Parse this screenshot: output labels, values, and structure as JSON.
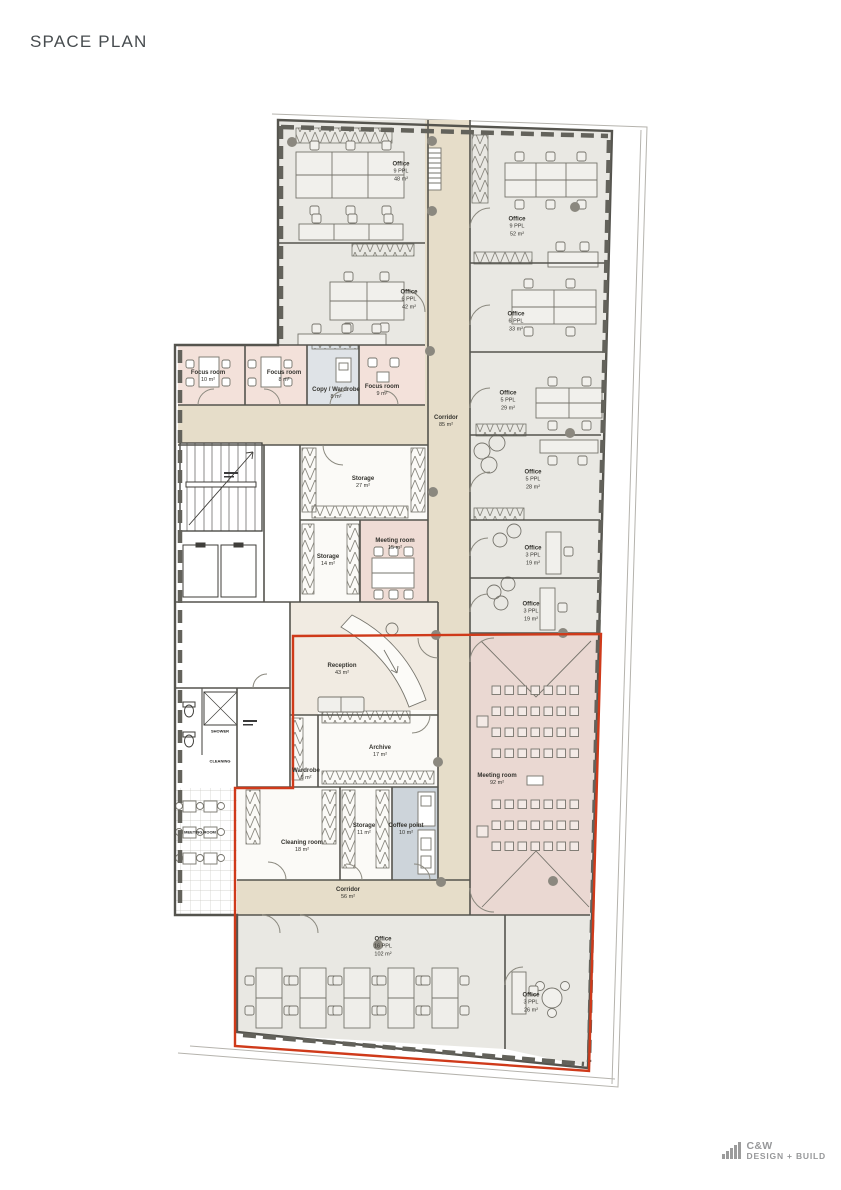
{
  "title": "SPACE PLAN",
  "logo": {
    "name": "C&W",
    "tagline": "DESIGN + BUILD"
  },
  "colors": {
    "corridor": "#e6ddc9",
    "office": "#e9e8e3",
    "focus_room": "#f3e1da",
    "meeting_room": "#ead8d2",
    "coffee_point": "#cdd4da",
    "reception": "#f1ebe2",
    "storage": "#fbfaf7",
    "wall": "#55544e",
    "highlight_outline": "#cf3a1a"
  },
  "rooms": [
    {
      "name": "Office",
      "ppl": "9 PPL",
      "area": "48 m²"
    },
    {
      "name": "Office",
      "ppl": "6 PPL",
      "area": "42 m²"
    },
    {
      "name": "Office",
      "ppl": "9 PPL",
      "area": "52 m²"
    },
    {
      "name": "Office",
      "ppl": "6 PPL",
      "area": "33 m²"
    },
    {
      "name": "Office",
      "ppl": "5 PPL",
      "area": "29 m²"
    },
    {
      "name": "Office",
      "ppl": "5 PPL",
      "area": "28 m²"
    },
    {
      "name": "Office",
      "ppl": "3 PPL",
      "area": "19 m²"
    },
    {
      "name": "Office",
      "ppl": "3 PPL",
      "area": "19 m²"
    },
    {
      "name": "Focus room",
      "ppl": "",
      "area": "10 m²"
    },
    {
      "name": "Focus room",
      "ppl": "",
      "area": "8 m²"
    },
    {
      "name": "Copy / Wardrobe",
      "ppl": "",
      "area": "8 m²"
    },
    {
      "name": "Focus room",
      "ppl": "",
      "area": "9 m²"
    },
    {
      "name": "Corridor",
      "ppl": "",
      "area": "85 m²"
    },
    {
      "name": "Storage",
      "ppl": "",
      "area": "27 m²"
    },
    {
      "name": "Storage",
      "ppl": "",
      "area": "14 m²"
    },
    {
      "name": "Meeting room",
      "ppl": "",
      "area": "15 m²"
    },
    {
      "name": "Reception",
      "ppl": "",
      "area": "43 m²"
    },
    {
      "name": "Wardrobe",
      "ppl": "",
      "area": "6 m²"
    },
    {
      "name": "Archive",
      "ppl": "",
      "area": "17 m²"
    },
    {
      "name": "Cleaning room",
      "ppl": "",
      "area": "18 m²"
    },
    {
      "name": "Storage",
      "ppl": "",
      "area": "11 m²"
    },
    {
      "name": "Coffee point",
      "ppl": "",
      "area": "10 m²"
    },
    {
      "name": "Corridor",
      "ppl": "",
      "area": "56 m²"
    },
    {
      "name": "Meeting room",
      "ppl": "",
      "area": "92 m²"
    },
    {
      "name": "Office",
      "ppl": "16 PPL",
      "area": "102 m²"
    },
    {
      "name": "Office",
      "ppl": "3 PPL",
      "area": "26 m²"
    }
  ],
  "core_labels": [
    {
      "text": "SHOWER"
    },
    {
      "text": "CLEANING"
    },
    {
      "text": "MEETING ROOM"
    }
  ]
}
